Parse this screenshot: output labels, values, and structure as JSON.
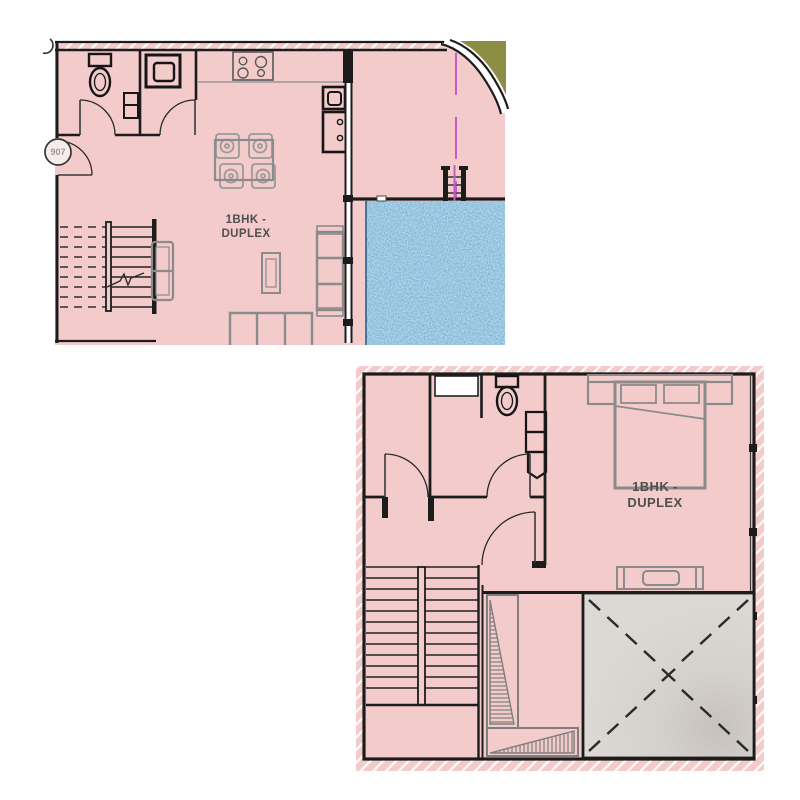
{
  "page": {
    "background": "#ffffff"
  },
  "plans": {
    "lower": {
      "label": {
        "line1": "1BHK -",
        "line2": "DUPLEX"
      },
      "unit_number": "907"
    },
    "upper": {
      "label": {
        "line1": "1BHK -",
        "line2": "DUPLEX"
      }
    }
  },
  "colors": {
    "room_fill": "#f2cbca",
    "wall": "#1c1c1c",
    "furniture_gray": "#8b8b8b",
    "label_text": "#4f4f4f",
    "pool_blue": "#4796c0",
    "void_fill": "#d9d6d2",
    "terrace_accent_olive": "#8d8d45",
    "centerline_magenta": "#c45ec4"
  }
}
